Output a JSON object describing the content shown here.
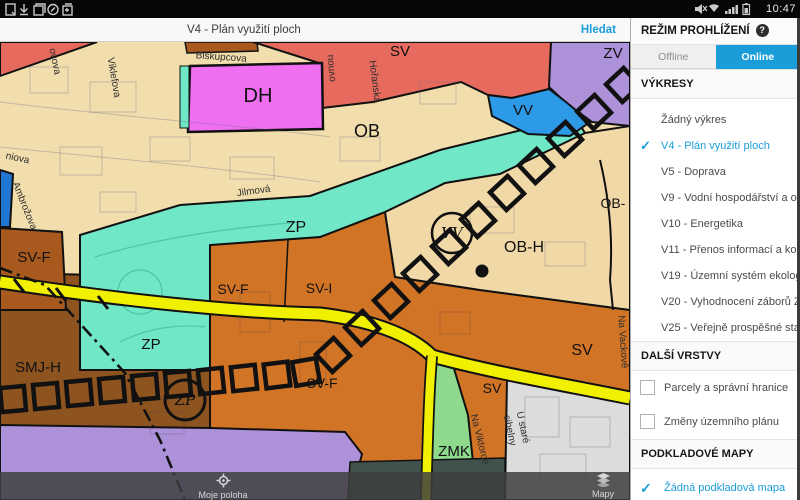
{
  "status_bar": {
    "time": "10:47",
    "left_icons": [
      "document-icon",
      "download-icon",
      "clipboard-icon",
      "compass-icon",
      "export-icon"
    ],
    "right_icons": [
      "mute-icon",
      "wifi-icon",
      "signal-icon",
      "battery-icon"
    ]
  },
  "app_bar": {
    "title": "V4 - Plán využití ploch",
    "search_label": "Hledat"
  },
  "sidebar": {
    "header": "REŽIM PROHLÍŽENÍ",
    "help_badge": "?",
    "tabs": [
      {
        "label": "Offline",
        "active": false
      },
      {
        "label": "Online",
        "active": true
      }
    ],
    "drawings_header": "VÝKRESY",
    "drawings": [
      {
        "label": "Žádný výkres",
        "selected": false
      },
      {
        "label": "V4 - Plán využití ploch",
        "selected": true
      },
      {
        "label": "V5 - Doprava",
        "selected": false
      },
      {
        "label": "V9 - Vodní hospodářství a odpa...",
        "selected": false
      },
      {
        "label": "V10 - Energetika",
        "selected": false
      },
      {
        "label": "V11 - Přenos informací a kolekto...",
        "selected": false
      },
      {
        "label": "V19 - Územní systém ekologické...",
        "selected": false
      },
      {
        "label": "V20 - Vyhodnocení záborů ZPF ...",
        "selected": false
      },
      {
        "label": "V25 - Veřejně prospěšné stavby",
        "selected": false
      }
    ],
    "layers_header": "DALŠÍ VRSTVY",
    "layers": [
      {
        "label": "Parcely a správní hranice",
        "checked": false
      },
      {
        "label": "Změny územního plánu",
        "checked": false
      }
    ],
    "basemaps_header": "PODKLADOVÉ MAPY",
    "basemaps": [
      {
        "label": "Žádná podkladová mapa",
        "selected": true
      }
    ],
    "check_glyph": "✓"
  },
  "bottom_bar": {
    "my_location": "Moje poloha",
    "maps": "Mapy"
  },
  "map": {
    "zone_labels": [
      {
        "text": "SV"
      },
      {
        "text": "ZV"
      },
      {
        "text": "DH"
      },
      {
        "text": "OB"
      },
      {
        "text": "VV"
      },
      {
        "text": "OB-"
      },
      {
        "text": "ZP"
      },
      {
        "text": "SV-F"
      },
      {
        "text": "SV-F"
      },
      {
        "text": "SV-I"
      },
      {
        "text": "OB-H"
      },
      {
        "text": "ZP"
      },
      {
        "text": "SMJ-H"
      },
      {
        "text": "SV-F"
      },
      {
        "text": "SV"
      },
      {
        "text": "SV"
      },
      {
        "text": "ZMK"
      },
      {
        "text": "DZ"
      },
      {
        "text": "VV"
      },
      {
        "text": "ZP"
      }
    ],
    "street_labels": [
      {
        "text": "ovova"
      },
      {
        "text": "Viklefova"
      },
      {
        "text": "Biskupcova"
      },
      {
        "text": "ovnou"
      },
      {
        "text": "Hořanská"
      },
      {
        "text": "niova"
      },
      {
        "text": "Ambrožova"
      },
      {
        "text": "Jilmová"
      },
      {
        "text": "Na Vackově"
      },
      {
        "text": "Na Viktorce"
      },
      {
        "text": "U staré"
      },
      {
        "text": "cihelny"
      }
    ],
    "legend_colors": {
      "OB_tan": "#F2DEAC",
      "OB_H_tan": "#F0D9A6",
      "OV_salmon": "#E76A5E",
      "DH_magenta": "#F06FF0",
      "ZV_purple": "#AD92DA",
      "VV_blue": "#2D9AE8",
      "ZP_teal": "#70E7C7",
      "SV_orange": "#D27425",
      "SV_F_sienna": "#A8591E",
      "SMJ_brown": "#8E5420",
      "ZMK_green": "#8FD98D",
      "gray_area": "#DCDCDC",
      "road_yellow": "#F0F000",
      "accent_blue": "#1B9DD9"
    }
  }
}
